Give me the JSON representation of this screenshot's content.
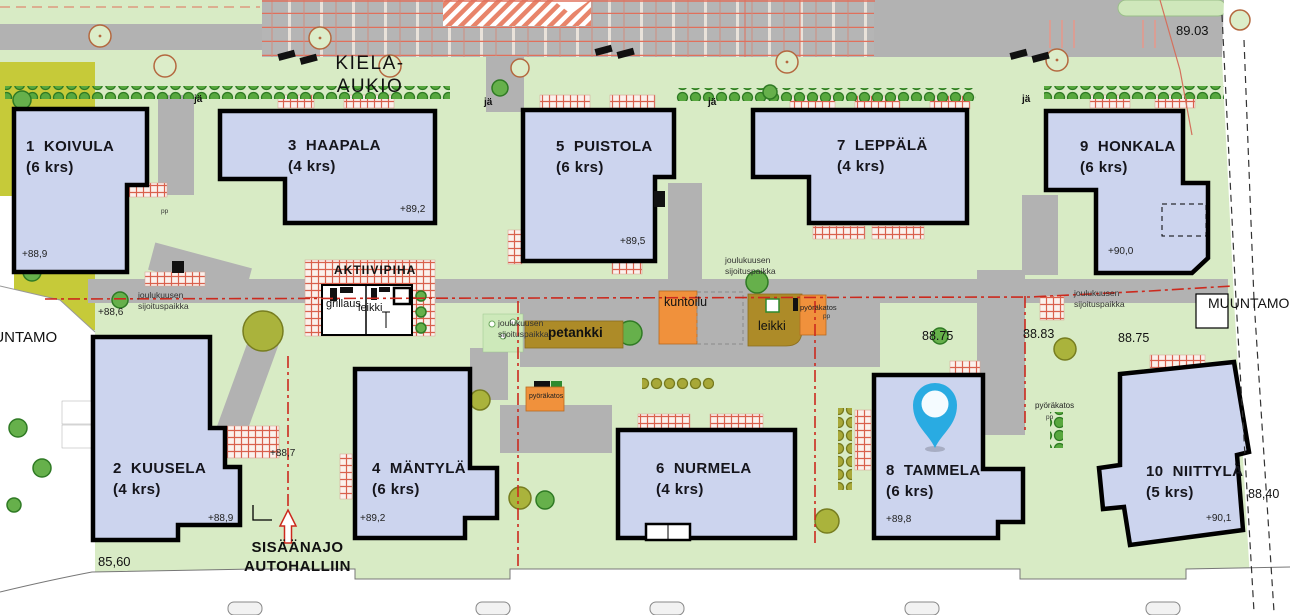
{
  "labels": {
    "plaza_line1": "KIELA-",
    "plaza_line2": "AUKIO",
    "muuntamo": "MUUNTAMO",
    "entrance_line1": "SISÄÄNAJO",
    "entrance_line2": "AUTOHALLIIN",
    "ja": "jä",
    "pp": "pp",
    "aktiivipiha": "AKTIIVIPIHA",
    "grillaus": "grillaus",
    "leikki": "leikki",
    "petankki": "petankki",
    "kuntoilu": "kuntoilu",
    "pyorakatos": "pyöräkatos",
    "joulukuusen_line1": "joulukuusen",
    "joulukuusen_line2": "sijoituspaikka"
  },
  "elevations": {
    "top_right": "89.03",
    "left": "+88,6",
    "kuusela_right": "+88,7",
    "mid_west": "88.75",
    "mid_center": "88.83",
    "mid_east": "88.75",
    "boundary_right": "88,40",
    "bottom_left": "85,60"
  },
  "buildings": [
    {
      "number": "1",
      "name": "1  KOIVULA",
      "floors": "(6 krs)",
      "elevation": "+88,9"
    },
    {
      "number": "2",
      "name": "2  KUUSELA",
      "floors": "(4 krs)",
      "elevation": "+88,9"
    },
    {
      "number": "3",
      "name": "3  HAAPALA",
      "floors": "(4 krs)",
      "elevation": "+89,2"
    },
    {
      "number": "4",
      "name": "4  MÄNTYLÄ",
      "floors": "(6 krs)",
      "elevation": "+89,2"
    },
    {
      "number": "5",
      "name": "5  PUISTOLA",
      "floors": "(6 krs)",
      "elevation": "+89,5"
    },
    {
      "number": "6",
      "name": "6  NURMELA",
      "floors": "(4 krs)"
    },
    {
      "number": "7",
      "name": "7  LEPPÄLÄ",
      "floors": "(4 krs)"
    },
    {
      "number": "8",
      "name": "8  TAMMELA",
      "floors": "(6 krs)",
      "elevation": "+89,8"
    },
    {
      "number": "9",
      "name": "9  HONKALA",
      "floors": "(6 krs)",
      "elevation": "+90,0"
    },
    {
      "number": "10",
      "name": "10  NIITTYLÄ",
      "floors": "(5 krs)",
      "elevation": "+90,1"
    }
  ],
  "colors": {
    "building_fill": "#ccd4ee",
    "background_green": "#d8ebc5",
    "road_gray": "#b2b2b2",
    "hatch_red": "#d9604c",
    "amenity_orange": "#f0913c",
    "amenity_olive": "#ad8b28",
    "line_red": "#cc2a1e",
    "pin_blue": "#29abe2"
  }
}
